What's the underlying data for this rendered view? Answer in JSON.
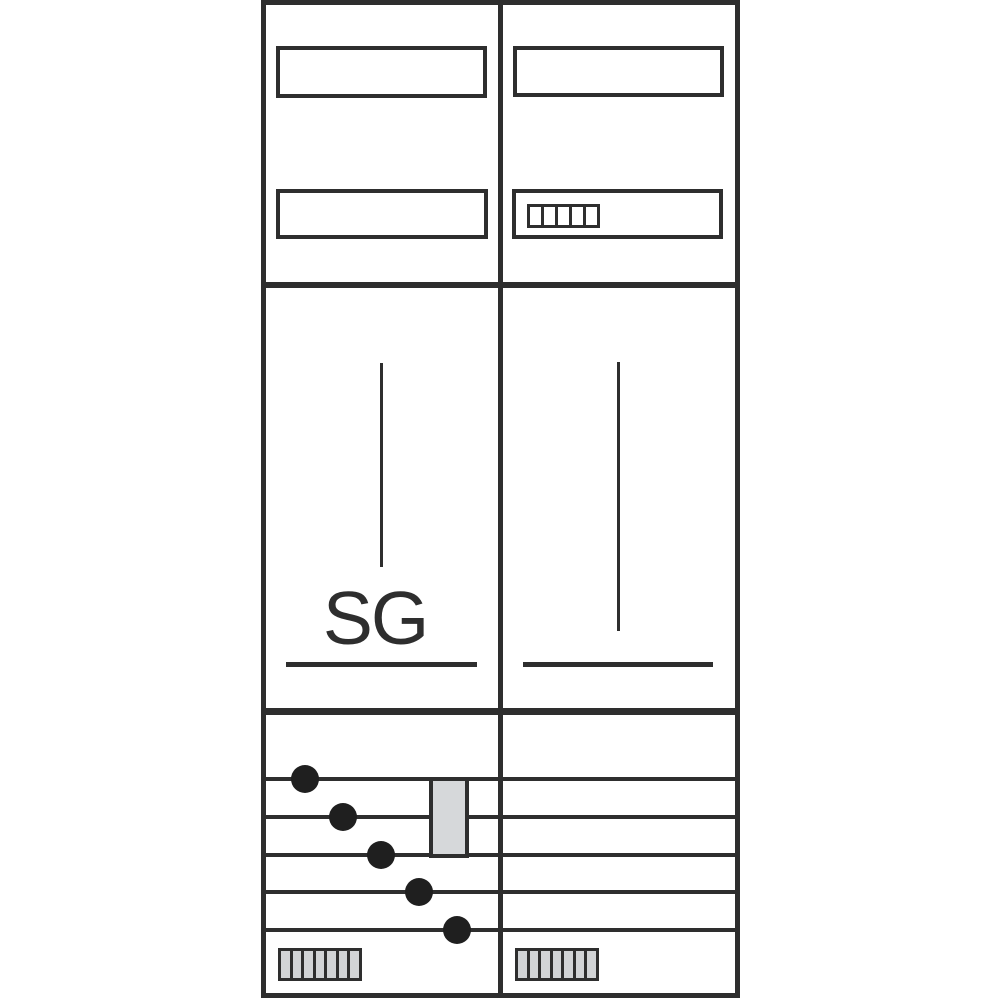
{
  "diagram": {
    "kind": "meter-cabinet-front-schematic",
    "labels": {
      "sg": "SG"
    },
    "colors": {
      "stroke": "#2e2e2e",
      "fill_gray": "#d6d8da",
      "bar_gray": "#d2d4d6",
      "dot": "#1f1f1f",
      "background": "#ffffff"
    },
    "counts": {
      "display_cells": 5,
      "terminal_bars": 7,
      "busbars": 5,
      "connection_dots": 5,
      "label_slots": 4
    }
  }
}
